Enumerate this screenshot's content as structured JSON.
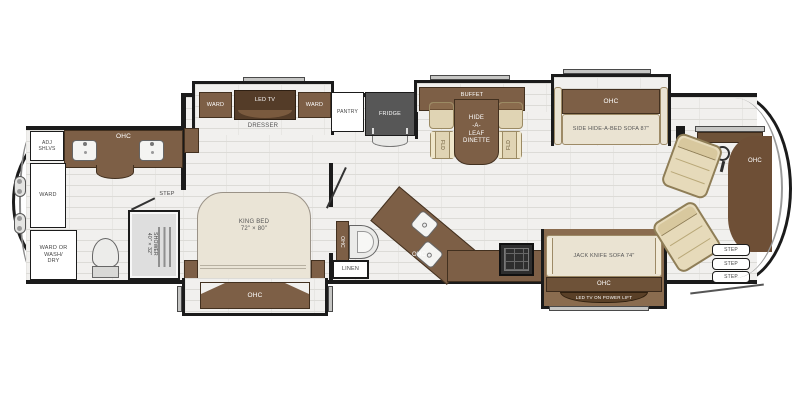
{
  "labels": {
    "rear_bath": {
      "ohc": "OHC",
      "adj_shlvs": "ADJ\nSHLVS",
      "ward": "WARD",
      "ward_or_wash_dry": "WARD OR\nWASH/\nDRY",
      "shower": "SHOWER\n40\" × 32\"",
      "step": "STEP"
    },
    "bedroom": {
      "ward_left": "WARD",
      "led_tv": "LED TV",
      "ward_right": "WARD",
      "dresser": "DRESSER",
      "king_bed": "KING BED\n72\" × 80\"",
      "ohc_foot": "OHC"
    },
    "half_bath": {
      "ohc": "OHC",
      "linen": "LINEN"
    },
    "kitchen": {
      "pantry": "PANTRY",
      "fridge": "FRIDGE",
      "ohc": "OHC"
    },
    "dinette": {
      "buffet_ohc": "BUFFET\nOHC",
      "table": "HIDE\n-A-\nLEAF\nDINETTE",
      "fld": "FLD"
    },
    "living": {
      "sofa_ohc": "OHC",
      "side_sofa": "SIDE HIDE-A-BED SOFA 87\"",
      "jack_knife_sofa": "JACK KNIFE SOFA 74\"",
      "jack_ohc": "OHC",
      "tv_lift": "LED TV ON POWER LIFT"
    },
    "cockpit": {
      "ohc": "OHC",
      "steps": [
        "STEP",
        "STEP",
        "STEP"
      ]
    }
  },
  "colors": {
    "wall": "#1b1b1b",
    "cabinet_brown": "#7d5f46",
    "mid_wood": "#6e5238",
    "dark_wood": "#5a4027",
    "slide_floor_brown": "#8a6c4f",
    "upholstery_cream": "#eae3d2",
    "chair_tan": "#e0d4b4",
    "seat_tan": "#e6daba",
    "fridge_gray": "#575757",
    "floor_gray": "#f1f0ee",
    "fixture_gray": "#dedede"
  }
}
